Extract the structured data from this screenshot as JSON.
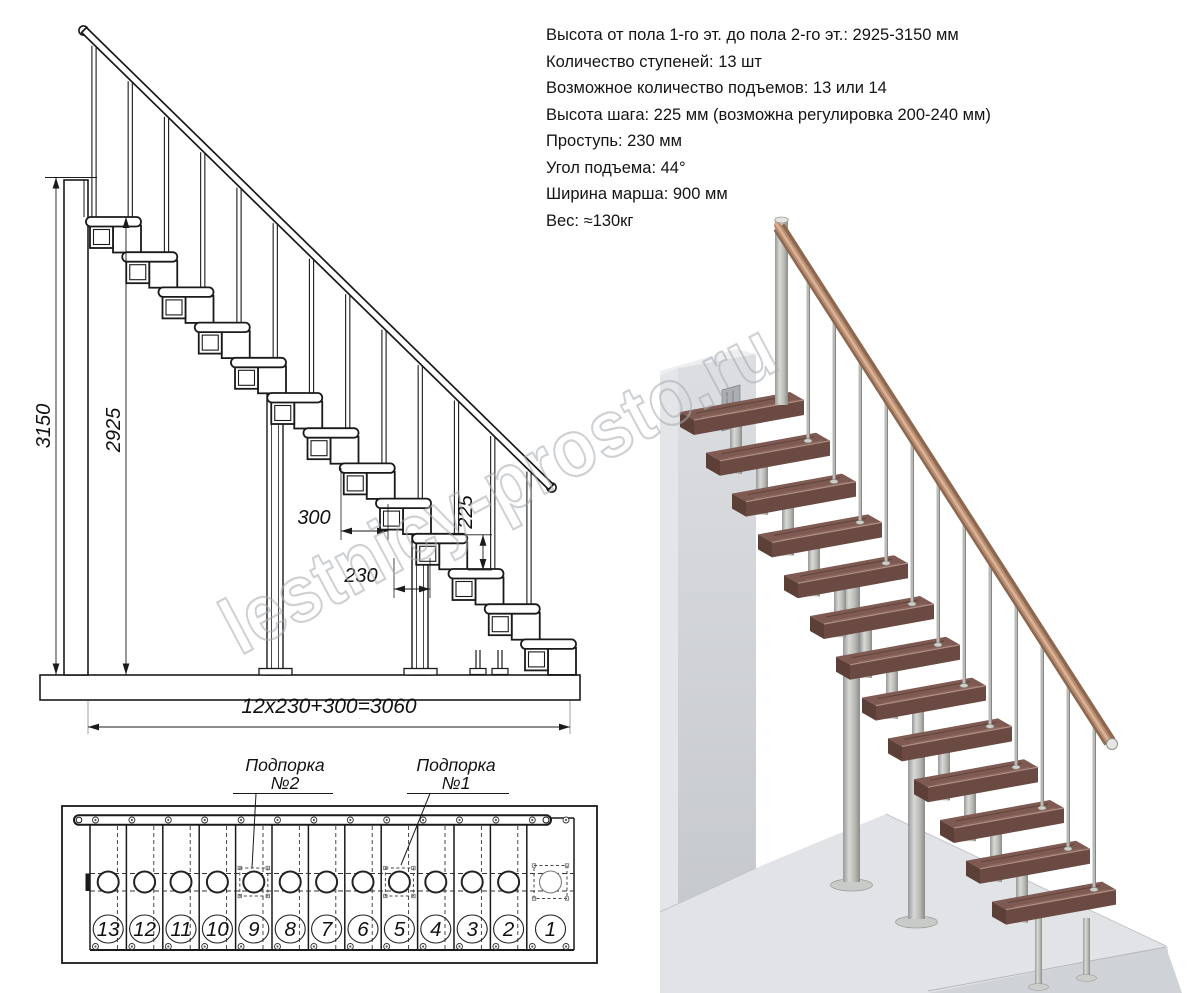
{
  "watermark": {
    "text": "lestnicy-prosto.ru"
  },
  "specs": {
    "lines": [
      "Высота от пола 1-го эт. до пола 2-го эт.: 2925-3150 мм",
      "Количество ступеней: 13 шт",
      "Возможное количество подъемов: 13 или 14",
      "Высота шага: 225 мм (возможна регулировка 200-240 мм)",
      "Проступь: 230 мм",
      "Угол подъема: 44°",
      "Ширина марша: 900 мм",
      "Вес: ≈130кг"
    ]
  },
  "elevation": {
    "steps_count": 13,
    "labels": {
      "h_total": "3150",
      "h_clear": "2925",
      "run_top": "300",
      "tread": "230",
      "rise": "225",
      "total_run": "12x230+300=3060"
    }
  },
  "plan": {
    "supports": [
      {
        "line1": "Подпорка",
        "line2": "№2"
      },
      {
        "line1": "Подпорка",
        "line2": "№1"
      }
    ],
    "numbers": [
      "13",
      "12",
      "11",
      "10",
      "9",
      "8",
      "7",
      "6",
      "5",
      "4",
      "3",
      "2",
      "1"
    ]
  },
  "colors": {
    "line": "#1a1a1a",
    "dim_text": "#111111",
    "watermark": "#a7acb2",
    "tread_top": "#7e5a52",
    "tread_front": "#6a4a42",
    "tread_side": "#5c4038",
    "tread_edge": "#b09086",
    "metal_mid": "#b4b5b1",
    "rail_base": "#8d6850",
    "rail_mid": "#b98d70",
    "rail_hi": "#dab297",
    "wall_side": "#e3e5e8",
    "wall_top": "#eceef0",
    "bracket": "#aaadb1",
    "floor_top": "#e1e3e7",
    "floor_front": "#cfd2d6"
  }
}
